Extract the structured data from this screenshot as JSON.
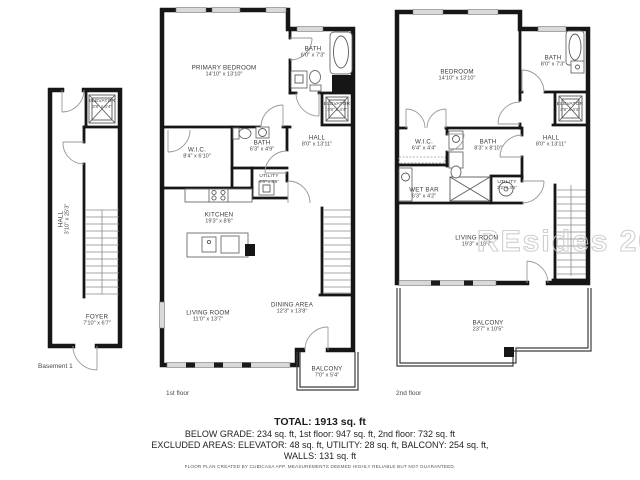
{
  "watermark": "REsides 2026",
  "floors": [
    {
      "label": "Basement 1",
      "rooms": [
        {
          "name": "ELEVATOR",
          "dims": "3'8\" x 4'4\""
        },
        {
          "name": "HALL",
          "dims": "3'10\" x 25'3\""
        },
        {
          "name": "FOYER",
          "dims": "7'10\" x 6'7\""
        }
      ]
    },
    {
      "label": "1st floor",
      "rooms": [
        {
          "name": "PRIMARY BEDROOM",
          "dims": "14'10\" x 13'10\""
        },
        {
          "name": "BATH",
          "dims": "6'0\" x 7'3\""
        },
        {
          "name": "ELEVATOR",
          "dims": "3'8\" x 4'4\""
        },
        {
          "name": "W.I.C.",
          "dims": "8'4\" x 6'10\""
        },
        {
          "name": "BATH",
          "dims": "6'3\" x 4'9\""
        },
        {
          "name": "HALL",
          "dims": "8'0\" x 13'11\""
        },
        {
          "name": "UTILITY",
          "dims": "4'0\" x 3'9\""
        },
        {
          "name": "KITCHEN",
          "dims": "19'3\" x 8'8\""
        },
        {
          "name": "LIVING ROOM",
          "dims": "11'0\" x 13'7\""
        },
        {
          "name": "DINING AREA",
          "dims": "12'3\" x 13'8\""
        },
        {
          "name": "BALCONY",
          "dims": "7'0\" x 5'4\""
        }
      ]
    },
    {
      "label": "2nd floor",
      "rooms": [
        {
          "name": "BEDROOM",
          "dims": "14'10\" x 13'10\""
        },
        {
          "name": "BATH",
          "dims": "8'0\" x 7'3\""
        },
        {
          "name": "ELEVATOR",
          "dims": "3'8\" x 4'4\""
        },
        {
          "name": "W.I.C.",
          "dims": "6'4\" x 4'4\""
        },
        {
          "name": "BATH",
          "dims": "8'3\" x 8'10\""
        },
        {
          "name": "HALL",
          "dims": "8'0\" x 13'11\""
        },
        {
          "name": "WET BAR",
          "dims": "6'3\" x 4'2\""
        },
        {
          "name": "UTILITY",
          "dims": "3'2\" x 3'6\""
        },
        {
          "name": "LIVING ROOM",
          "dims": "19'3\" x 10'7\""
        },
        {
          "name": "BALCONY",
          "dims": "23'7\" x 10'5\""
        }
      ]
    }
  ],
  "summary": {
    "total": "TOTAL: 1913 sq. ft",
    "breakdown": "BELOW GRADE: 234 sq. ft, 1st floor: 947 sq. ft, 2nd floor: 732 sq. ft",
    "excluded": "EXCLUDED AREAS: ELEVATOR: 48 sq. ft, UTILITY: 28 sq. ft, BALCONY: 254 sq. ft,",
    "walls": "WALLS: 131 sq. ft",
    "disclaimer": "FLOOR PLAN CREATED BY CUBICASA APP. MEASUREMENTS DEEMED HIGHLY RELIABLE BUT NOT GUARANTEED."
  }
}
